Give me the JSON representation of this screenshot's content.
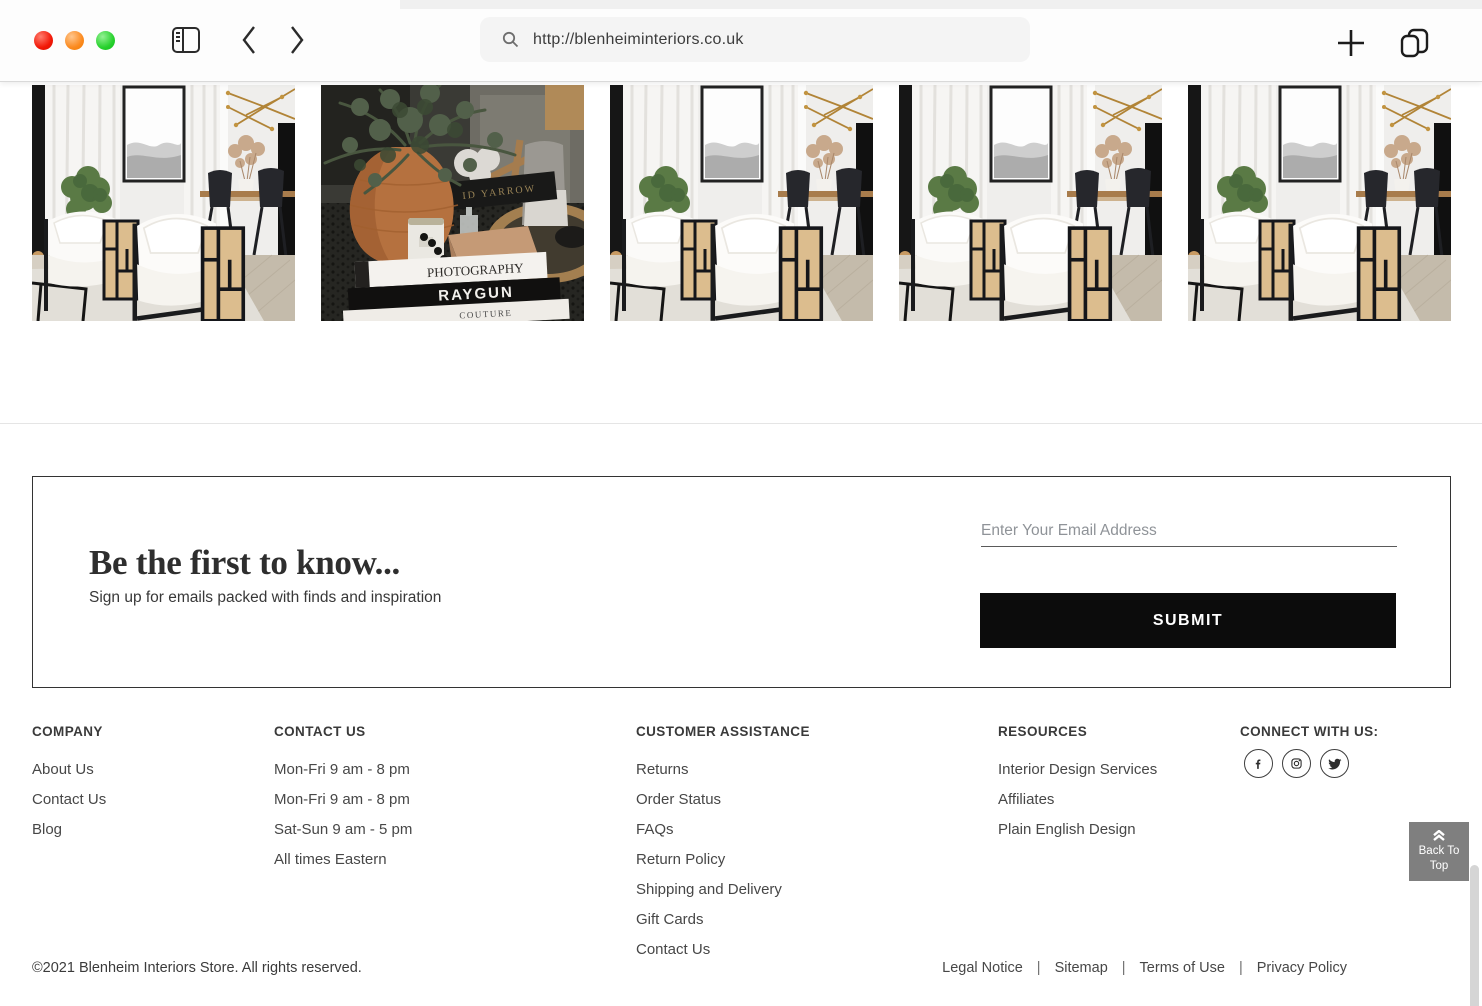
{
  "browser": {
    "url": "http://blenheiminteriors.co.uk"
  },
  "gallery": {
    "items": [
      {
        "alt": "Living room with white cane armchairs and black dining set"
      },
      {
        "alt": "Terracotta pot with evergreen sprigs styled on coffee table books"
      },
      {
        "alt": "Living room with white cane armchairs and black dining set"
      },
      {
        "alt": "Living room with white cane armchairs and black dining set"
      },
      {
        "alt": "Living room with white cane armchairs and black dining set"
      }
    ],
    "book_titles": {
      "back": "ID YARROW",
      "top": "PHOTOGRAPHY",
      "middle": "RAYGUN",
      "bottom": "COUTURE"
    }
  },
  "newsletter": {
    "title": "Be the first to know...",
    "subtitle": "Sign up for emails packed with finds and inspiration",
    "email_placeholder": "Enter Your Email Address",
    "submit_label": "SUBMIT"
  },
  "footer": {
    "columns": [
      {
        "heading": "COMPANY",
        "links": [
          "About Us",
          "Contact Us",
          "Blog"
        ]
      },
      {
        "heading": "CONTACT US",
        "items": [
          "Mon-Fri 9 am - 8 pm",
          "Mon-Fri 9 am - 8 pm",
          "Sat-Sun 9 am - 5 pm",
          "All times Eastern"
        ]
      },
      {
        "heading": "CUSTOMER ASSISTANCE",
        "links": [
          "Returns",
          "Order Status",
          "FAQs",
          "Return Policy",
          "Shipping and Delivery",
          "Gift Cards",
          "Contact Us"
        ]
      },
      {
        "heading": "RESOURCES",
        "links": [
          "Interior Design Services",
          "Affiliates",
          "Plain English Design"
        ]
      }
    ],
    "connect": {
      "heading": "CONNECT WITH US:",
      "icons": [
        "facebook",
        "instagram",
        "twitter"
      ]
    },
    "back_to_top": "Back To Top",
    "copyright": "©2021 Blenheim Interiors Store. All rights reserved.",
    "legal": {
      "separator": "|",
      "links": [
        "Legal Notice",
        "Sitemap",
        "Terms of Use",
        "Privacy Policy"
      ]
    }
  },
  "colors": {
    "submit_bg": "#0c0c0c",
    "back_to_top_bg": "#7f7f7f",
    "traffic_red": "#f21807",
    "traffic_orange": "#fb8a1f",
    "traffic_green": "#27d12d"
  }
}
